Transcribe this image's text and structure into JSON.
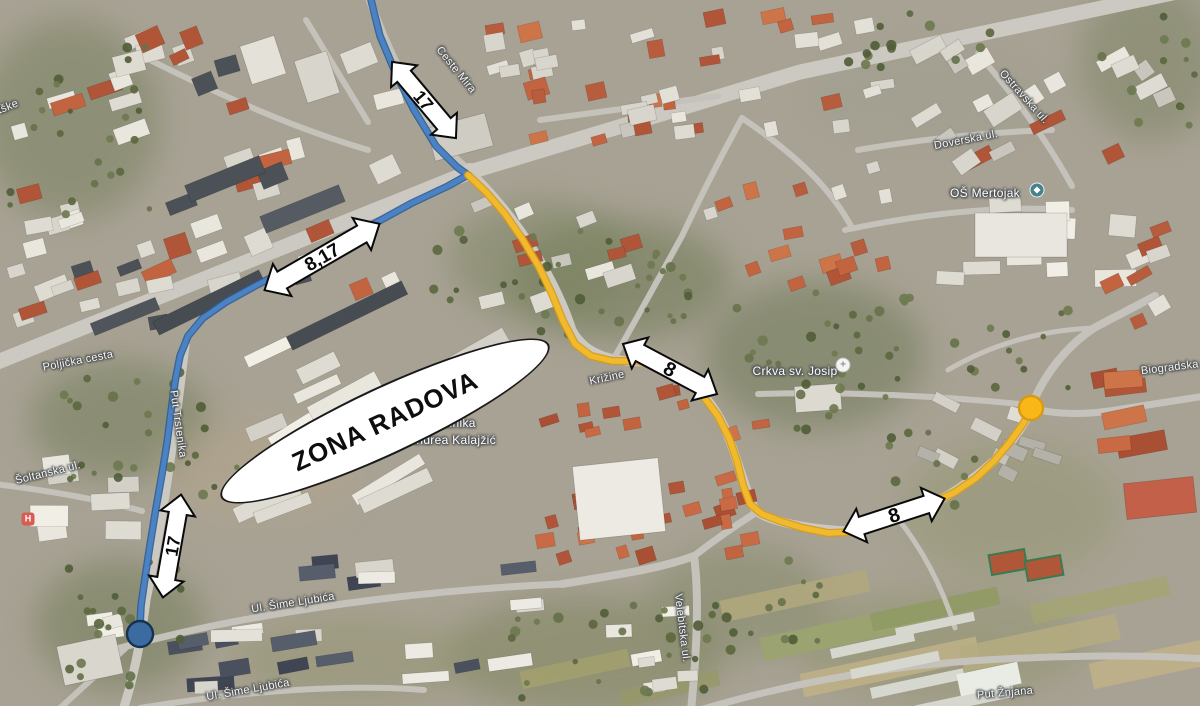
{
  "map": {
    "background_base_color": "#a8a294",
    "zone_label": {
      "text": "ZONA RADOVA",
      "x": 385,
      "y": 421,
      "width": 362,
      "height": 68,
      "rotation": -25,
      "fill": "#ffffff",
      "border": "#1a1a1a",
      "font_size": 26
    },
    "routes": [
      {
        "name": "detour-line-blue-17",
        "color": "#4a82c4",
        "outline": "#2e5d94",
        "width": 5,
        "points": [
          [
            370,
            -4
          ],
          [
            380,
            36
          ],
          [
            396,
            74
          ],
          [
            414,
            110
          ],
          [
            436,
            146
          ],
          [
            457,
            167
          ],
          [
            468,
            175
          ],
          [
            448,
            186
          ],
          [
            412,
            203
          ],
          [
            370,
            226
          ],
          [
            328,
            248
          ],
          [
            290,
            268
          ],
          [
            255,
            286
          ],
          [
            226,
            302
          ],
          [
            203,
            318
          ],
          [
            188,
            336
          ],
          [
            180,
            356
          ],
          [
            175,
            382
          ],
          [
            171,
            412
          ],
          [
            167,
            443
          ],
          [
            162,
            474
          ],
          [
            156,
            508
          ],
          [
            150,
            545
          ],
          [
            145,
            578
          ],
          [
            141,
            606
          ],
          [
            140,
            626
          ]
        ]
      },
      {
        "name": "detour-line-yellow-8",
        "color": "#f1ba2c",
        "outline": "#d79a18",
        "width": 5.5,
        "points": [
          [
            468,
            175
          ],
          [
            486,
            192
          ],
          [
            505,
            214
          ],
          [
            523,
            240
          ],
          [
            539,
            267
          ],
          [
            552,
            294
          ],
          [
            563,
            321
          ],
          [
            575,
            344
          ],
          [
            591,
            356
          ],
          [
            612,
            361
          ],
          [
            638,
            361
          ],
          [
            662,
            367
          ],
          [
            684,
            379
          ],
          [
            703,
            396
          ],
          [
            718,
            416
          ],
          [
            729,
            438
          ],
          [
            737,
            461
          ],
          [
            743,
            485
          ],
          [
            750,
            504
          ],
          [
            762,
            514
          ],
          [
            780,
            521
          ],
          [
            803,
            528
          ],
          [
            828,
            533
          ],
          [
            854,
            532
          ],
          [
            880,
            524
          ],
          [
            906,
            515
          ],
          [
            931,
            504
          ],
          [
            955,
            492
          ],
          [
            976,
            478
          ],
          [
            994,
            461
          ],
          [
            1010,
            442
          ],
          [
            1023,
            424
          ],
          [
            1030,
            411
          ]
        ]
      }
    ],
    "markers": [
      {
        "name": "endpoint-blue",
        "x": 140,
        "y": 634,
        "radius": 13,
        "fill": "#3b6ba1",
        "stroke": "#16324f"
      },
      {
        "name": "endpoint-yellow",
        "x": 1031,
        "y": 408,
        "radius": 12,
        "fill": "#f9b718",
        "stroke": "#d79a18"
      }
    ],
    "arrow_style": {
      "fill": "#ffffff",
      "stroke": "#0a0a0a"
    },
    "arrows": [
      {
        "label": "17",
        "x": 424,
        "y": 100,
        "rotation": 50,
        "length": 62,
        "width": 34,
        "font_size": 18
      },
      {
        "label": "8,17",
        "x": 322,
        "y": 257,
        "rotation": -30,
        "length": 92,
        "width": 37,
        "font_size": 19
      },
      {
        "label": "8",
        "x": 670,
        "y": 369,
        "rotation": 28,
        "length": 68,
        "width": 35,
        "font_size": 20
      },
      {
        "label": "8",
        "x": 894,
        "y": 515,
        "rotation": -18,
        "length": 68,
        "width": 35,
        "font_size": 20
      },
      {
        "label": "17",
        "x": 172,
        "y": 546,
        "rotation": -80,
        "length": 66,
        "width": 35,
        "font_size": 18
      }
    ],
    "street_labels": [
      {
        "text": "tške",
        "x": 8,
        "y": 107,
        "rotation": -22
      },
      {
        "text": "Ceste Mira",
        "x": 456,
        "y": 70,
        "rotation": 51
      },
      {
        "text": "Poljička cesta",
        "x": 78,
        "y": 361,
        "rotation": -11
      },
      {
        "text": "Put Trstenika",
        "x": 178,
        "y": 424,
        "rotation": 82
      },
      {
        "text": "Šoltanska ul.",
        "x": 48,
        "y": 473,
        "rotation": -14
      },
      {
        "text": "Ostravska ul.",
        "x": 1024,
        "y": 97,
        "rotation": 48
      },
      {
        "text": "Doverska ul.",
        "x": 966,
        "y": 140,
        "rotation": -11
      },
      {
        "text": "Biogradska ul",
        "x": 1176,
        "y": 367,
        "rotation": -7
      },
      {
        "text": "Križine",
        "x": 607,
        "y": 378,
        "rotation": -12
      },
      {
        "text": "Ul. Šime Ljubića",
        "x": 293,
        "y": 603,
        "rotation": -9
      },
      {
        "text": "Ul. Šime Ljubića",
        "x": 248,
        "y": 690,
        "rotation": -10
      },
      {
        "text": "Velebitska ul.",
        "x": 682,
        "y": 628,
        "rotation": 83
      },
      {
        "text": "Put Žnjana",
        "x": 1005,
        "y": 693,
        "rotation": -5
      }
    ],
    "poi_labels": [
      {
        "text": "OŠ Mertojak",
        "x": 985,
        "y": 193,
        "rotation": 0
      },
      {
        "text": "Crkva sv. Josip",
        "x": 795,
        "y": 371,
        "rotation": 0
      },
      {
        "text": "Klinika",
        "x": 457,
        "y": 423,
        "rotation": 0
      },
      {
        "text": "Andrea Kalajžić",
        "x": 452,
        "y": 440,
        "rotation": 0
      }
    ],
    "poi_icons": [
      {
        "type": "school",
        "x": 1037,
        "y": 190
      },
      {
        "type": "church",
        "x": 843,
        "y": 365
      },
      {
        "type": "hospital",
        "x": 28,
        "y": 519
      }
    ]
  }
}
